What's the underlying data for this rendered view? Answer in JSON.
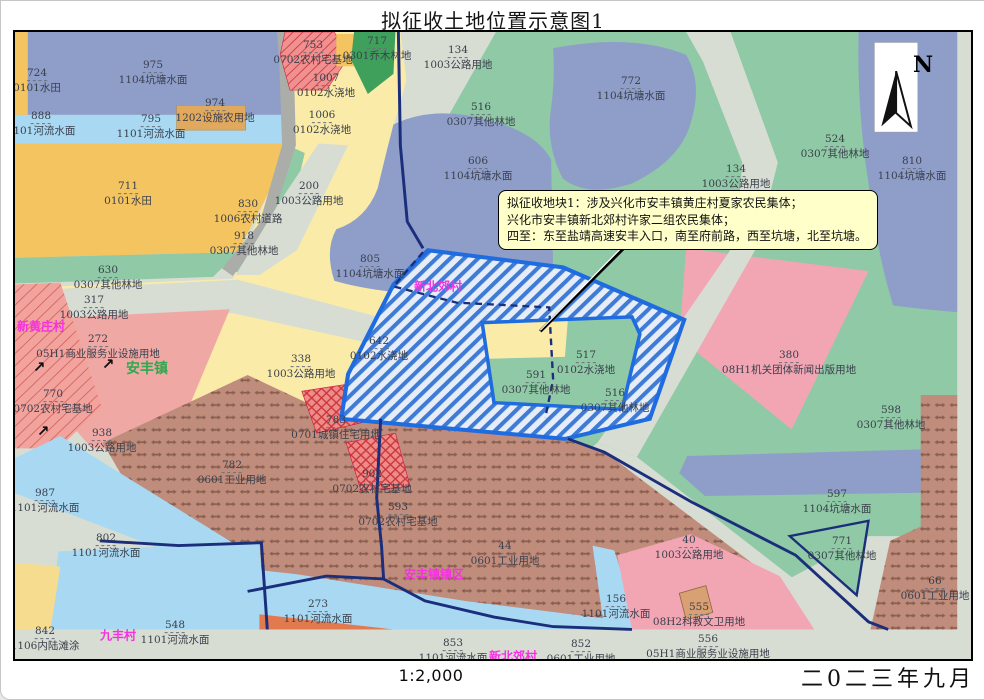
{
  "title": "拟征收土地位置示意图1",
  "footer": {
    "scale": "1:2,000",
    "date": "二0二三年九月"
  },
  "north": {
    "label": "N"
  },
  "callout": {
    "line1": "拟征收地块1：涉及兴化市安丰镇黄庄村夏家农民集体；",
    "line2": "兴化市安丰镇新北郊村许家二组农民集体；",
    "line3": "四至：东至盐靖高速安丰入口，南至府前路，西至坑塘，北至坑塘。"
  },
  "legend_colors": {
    "pond_water": "#8E9EC9",
    "river_water": "#A9D9F2",
    "paddy_field": "#F3C45F",
    "irrigated_land": "#FAEBA8",
    "forest": "#90C9A5",
    "arbor_forest": "#3FA05C",
    "road": "#D7DDD3",
    "industrial": "#C08D7D",
    "rural_homestead": "#EF8B8B",
    "commercial_pink": "#F2A6B4",
    "facility_agri": "#E0A95E",
    "plot_border": "#1F6BE0",
    "admin_boundary": "#1B2E7B",
    "village_label": "#F531E2",
    "town_label": "#2FA84F"
  },
  "villages": [
    {
      "t": "新黄庄村",
      "x": 40,
      "y": 325,
      "color": "#F531E2",
      "size": 12
    },
    {
      "t": "安丰镇",
      "x": 146,
      "y": 367,
      "color": "#2FA84F",
      "size": 14
    },
    {
      "t": "新北郊村",
      "x": 437,
      "y": 285,
      "color": "#F531E2",
      "size": 12
    },
    {
      "t": "安丰镇镇区",
      "x": 433,
      "y": 573,
      "color": "#F531E2",
      "size": 12
    },
    {
      "t": "九丰村",
      "x": 117,
      "y": 634,
      "color": "#F531E2",
      "size": 12
    },
    {
      "t": "新北郊村",
      "x": 512,
      "y": 655,
      "color": "#F531E2",
      "size": 12
    }
  ],
  "arrows": {
    "glyph": "↗",
    "positions": [
      {
        "x": 38,
        "y": 366
      },
      {
        "x": 107,
        "y": 363
      },
      {
        "x": 42,
        "y": 430
      }
    ]
  },
  "parcels": [
    {
      "n": "724",
      "t": "0101水田",
      "x": 36,
      "y": 80
    },
    {
      "n": "975",
      "t": "1104坑塘水面",
      "x": 152,
      "y": 72
    },
    {
      "n": "974",
      "t": "1202设施农用地",
      "x": 214,
      "y": 110
    },
    {
      "n": "888",
      "t": "1101河流水面",
      "x": 40,
      "y": 123
    },
    {
      "n": "795",
      "t": "1101河流水面",
      "x": 150,
      "y": 126
    },
    {
      "n": "711",
      "t": "0101水田",
      "x": 127,
      "y": 193
    },
    {
      "n": "753",
      "t": "0702农村宅基地",
      "x": 312,
      "y": 52
    },
    {
      "n": "717",
      "t": "0301乔木林地",
      "x": 376,
      "y": 48
    },
    {
      "n": "134",
      "t": "1003公路用地",
      "x": 457,
      "y": 57
    },
    {
      "n": "1007",
      "t": "0102水浇地",
      "x": 325,
      "y": 85
    },
    {
      "n": "1006",
      "t": "0102水浇地",
      "x": 321,
      "y": 122
    },
    {
      "n": "516",
      "t": "0307其他林地",
      "x": 480,
      "y": 114
    },
    {
      "n": "772",
      "t": "1104坑塘水面",
      "x": 630,
      "y": 88
    },
    {
      "n": "606",
      "t": "1104坑塘水面",
      "x": 477,
      "y": 168
    },
    {
      "n": "134",
      "t": "1003公路用地",
      "x": 735,
      "y": 176
    },
    {
      "n": "524",
      "t": "0307其他林地",
      "x": 834,
      "y": 146
    },
    {
      "n": "810",
      "t": "1104坑塘水面",
      "x": 911,
      "y": 168
    },
    {
      "n": "200",
      "t": "1003公路用地",
      "x": 308,
      "y": 193
    },
    {
      "n": "830",
      "t": "1006农村道路",
      "x": 247,
      "y": 211
    },
    {
      "n": "918",
      "t": "0307其他林地",
      "x": 243,
      "y": 243
    },
    {
      "n": "630",
      "t": "0307其他林地",
      "x": 107,
      "y": 277
    },
    {
      "n": "317",
      "t": "1003公路用地",
      "x": 93,
      "y": 307
    },
    {
      "n": "272",
      "t": "05H1商业服务业设施用地",
      "x": 97,
      "y": 346
    },
    {
      "n": "770",
      "t": "0702农村宅基地",
      "x": 52,
      "y": 401
    },
    {
      "n": "938",
      "t": "1003公路用地",
      "x": 101,
      "y": 440
    },
    {
      "n": "805",
      "t": "1104坑塘水面",
      "x": 369,
      "y": 266
    },
    {
      "n": "338",
      "t": "1003公路用地",
      "x": 300,
      "y": 366
    },
    {
      "n": "642",
      "t": "0102水浇地",
      "x": 378,
      "y": 348
    },
    {
      "n": "517",
      "t": "0102水浇地",
      "x": 585,
      "y": 362
    },
    {
      "n": "591",
      "t": "0307其他林地",
      "x": 535,
      "y": 382
    },
    {
      "n": "516",
      "t": "0307其他林地",
      "x": 614,
      "y": 400
    },
    {
      "n": "380",
      "t": "08H1机关团体新闻出版用地",
      "x": 788,
      "y": 362
    },
    {
      "n": "598",
      "t": "0307其他林地",
      "x": 890,
      "y": 417
    },
    {
      "n": "783",
      "t": "0701城镇住宅用地",
      "x": 335,
      "y": 427
    },
    {
      "n": "902",
      "t": "0702农村宅基地",
      "x": 371,
      "y": 481
    },
    {
      "n": "593",
      "t": "0702农村宅基地",
      "x": 397,
      "y": 514
    },
    {
      "n": "782",
      "t": "0601工业用地",
      "x": 231,
      "y": 472
    },
    {
      "n": "987",
      "t": "1101河流水面",
      "x": 44,
      "y": 500
    },
    {
      "n": "802",
      "t": "1101河流水面",
      "x": 105,
      "y": 545
    },
    {
      "n": "842",
      "t": "1106内陆滩涂",
      "x": 44,
      "y": 638
    },
    {
      "n": "548",
      "t": "1101河流水面",
      "x": 174,
      "y": 632
    },
    {
      "n": "273",
      "t": "1101河流水面",
      "x": 317,
      "y": 611
    },
    {
      "n": "44",
      "t": "0601工业用地",
      "x": 504,
      "y": 553
    },
    {
      "n": "853",
      "t": "1101河流水面",
      "x": 452,
      "y": 650
    },
    {
      "n": "852",
      "t": "0601工业用地",
      "x": 580,
      "y": 651
    },
    {
      "n": "156",
      "t": "1101河流水面",
      "x": 615,
      "y": 606
    },
    {
      "n": "555",
      "t": "08H2科教文卫用地",
      "x": 698,
      "y": 614
    },
    {
      "n": "556",
      "t": "05H1商业服务业设施用地",
      "x": 707,
      "y": 646
    },
    {
      "n": "40",
      "t": "1003公路用地",
      "x": 688,
      "y": 547
    },
    {
      "n": "771",
      "t": "0307其他林地",
      "x": 841,
      "y": 548
    },
    {
      "n": "597",
      "t": "1104坑塘水面",
      "x": 836,
      "y": 501
    },
    {
      "n": "66",
      "t": "0601工业用地",
      "x": 934,
      "y": 588
    }
  ]
}
